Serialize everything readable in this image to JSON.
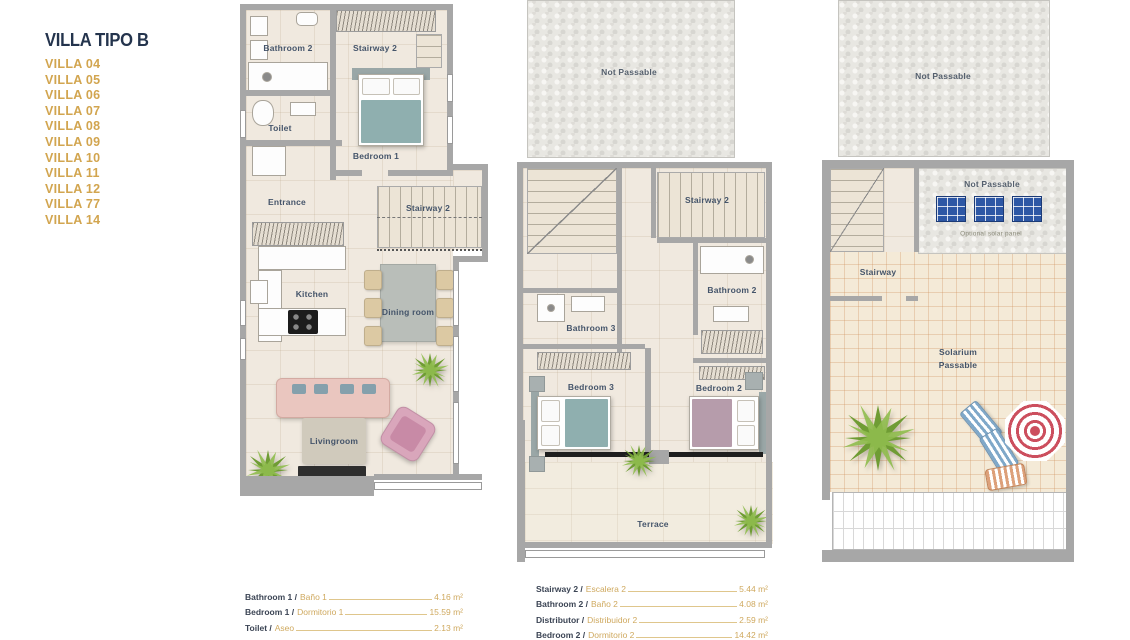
{
  "sidebar": {
    "title": "VILLA TIPO B",
    "villas": [
      "VILLA 04",
      "VILLA 05",
      "VILLA 06",
      "VILLA 07",
      "VILLA 08",
      "VILLA 09",
      "VILLA 10",
      "VILLA 11",
      "VILLA 12",
      "VILLA 77",
      "VILLA 14"
    ]
  },
  "ground": {
    "bathroom2": "Bathroom 2",
    "stairway2_upper": "Stairway 2",
    "toilet": "Toilet",
    "bedroom1": "Bedroom 1",
    "entrance": "Entrance",
    "stairway2_lower": "Stairway 2",
    "kitchen": "Kitchen",
    "dining_room": "Dining room",
    "livingroom": "Livingroom"
  },
  "first": {
    "not_passable": "Not Passable",
    "stairway2": "Stairway 2",
    "bathroom2": "Bathroom 2",
    "bathroom3": "Bathroom 3",
    "bedroom3": "Bedroom 3",
    "bedroom2": "Bedroom 2",
    "terrace": "Terrace"
  },
  "roof": {
    "not_passable_upper": "Not Passable",
    "not_passable_solar": "Not Passable",
    "solar_caption": "Optional solar panel",
    "stairway": "Stairway",
    "solarium_line1": "Solarium",
    "solarium_line2": "Passable"
  },
  "legend": {
    "col1": [
      {
        "en": "Bathroom 1 /",
        "es": "Baño 1",
        "value": "4.16 m²"
      },
      {
        "en": "Bedroom 1 /",
        "es": "Dormitorio 1",
        "value": "15.59 m²"
      },
      {
        "en": "Toilet /",
        "es": "Aseo",
        "value": "2.13 m²"
      }
    ],
    "col2": [
      {
        "en": "Stairway 2 /",
        "es": "Escalera 2",
        "value": "5.44 m²"
      },
      {
        "en": "Bathroom 2 /",
        "es": "Baño 2",
        "value": "4.08 m²"
      },
      {
        "en": "Distributor /",
        "es": "Distribuidor 2",
        "value": "2.59 m²"
      },
      {
        "en": "Bedroom 2 /",
        "es": "Dormitorio 2",
        "value": "14.42 m²"
      }
    ]
  },
  "colors": {
    "accent_gold": "#d2a54f",
    "title_navy": "#24344d",
    "label_slate": "#44546a",
    "wall_gray": "#a7a7a7",
    "floor_beige": "#f0e9df",
    "solarium_cream": "#f4ead7",
    "solar_panel_blue": "#2d57a5",
    "bed_teal": "#8fafaf",
    "bed_mauve": "#b69cab",
    "sofa_pink": "#eac6bf",
    "plant_green": "#6f9c34",
    "umbrella_red": "#cc4f5e"
  }
}
